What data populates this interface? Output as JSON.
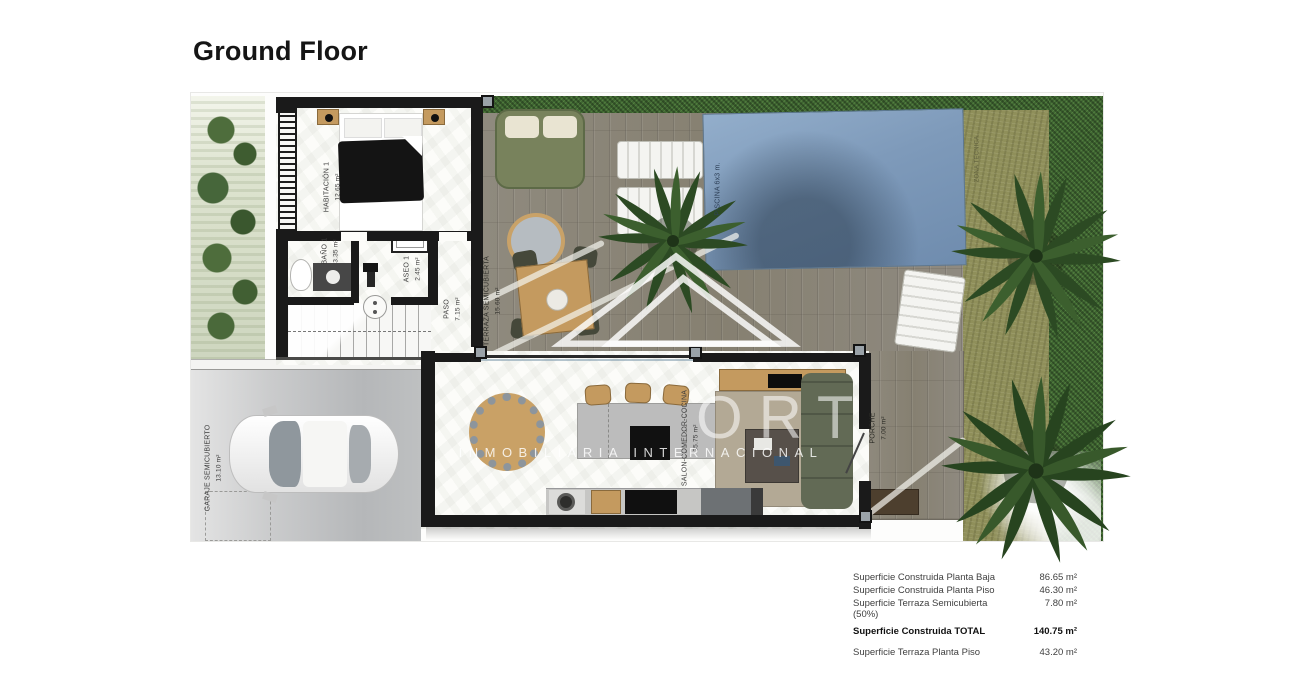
{
  "title": "Ground Floor",
  "rooms": {
    "habitacion": {
      "label": "HABITACIÓN 1",
      "area": "12.65 m²"
    },
    "bano": {
      "label": "BAÑO 1",
      "area": "3.35 m²"
    },
    "aseo": {
      "label": "ASEO 1",
      "area": "2.45 m²"
    },
    "paso": {
      "label": "PASO",
      "area": "7.15 m²"
    },
    "terraza": {
      "label": "TERRAZA SEMICUBIERTA",
      "area": "15.60 m²"
    },
    "salon": {
      "label": "SALON-COMEDOR-COCINA",
      "area": "35.75 m²"
    },
    "garaje": {
      "label": "GARAJE SEMICUBIERTO",
      "area": "13.10 m²"
    },
    "porche": {
      "label": "PORCHE",
      "area": "7.00 m²"
    },
    "piscina": {
      "label": "PISCINA 6x3 m."
    },
    "zona": {
      "label": "ZONA TECNICA"
    }
  },
  "watermark": {
    "brand_fragment": "ORT",
    "subtitle": "INMOBILIARIA INTERNACIONAL"
  },
  "summary": {
    "rows": [
      {
        "label": "Superficie Construida Planta Baja",
        "value": "86.65 m²"
      },
      {
        "label": "Superficie Construida Planta Piso",
        "value": "46.30 m²"
      },
      {
        "label": "Superficie Terraza Semicubierta (50%)",
        "value": "7.80 m²"
      },
      {
        "label": "Superficie Construida TOTAL",
        "value": "140.75 m²"
      },
      {
        "label": "Superficie Terraza Planta Piso",
        "value": "43.20 m²"
      }
    ]
  },
  "colors": {
    "pool_blue": "#7e9aba",
    "deck_wood": "#8e897d",
    "hedge_green": "#3f6632",
    "grass_olive": "#8f8f5a",
    "wall_black": "#1a1a1a"
  }
}
